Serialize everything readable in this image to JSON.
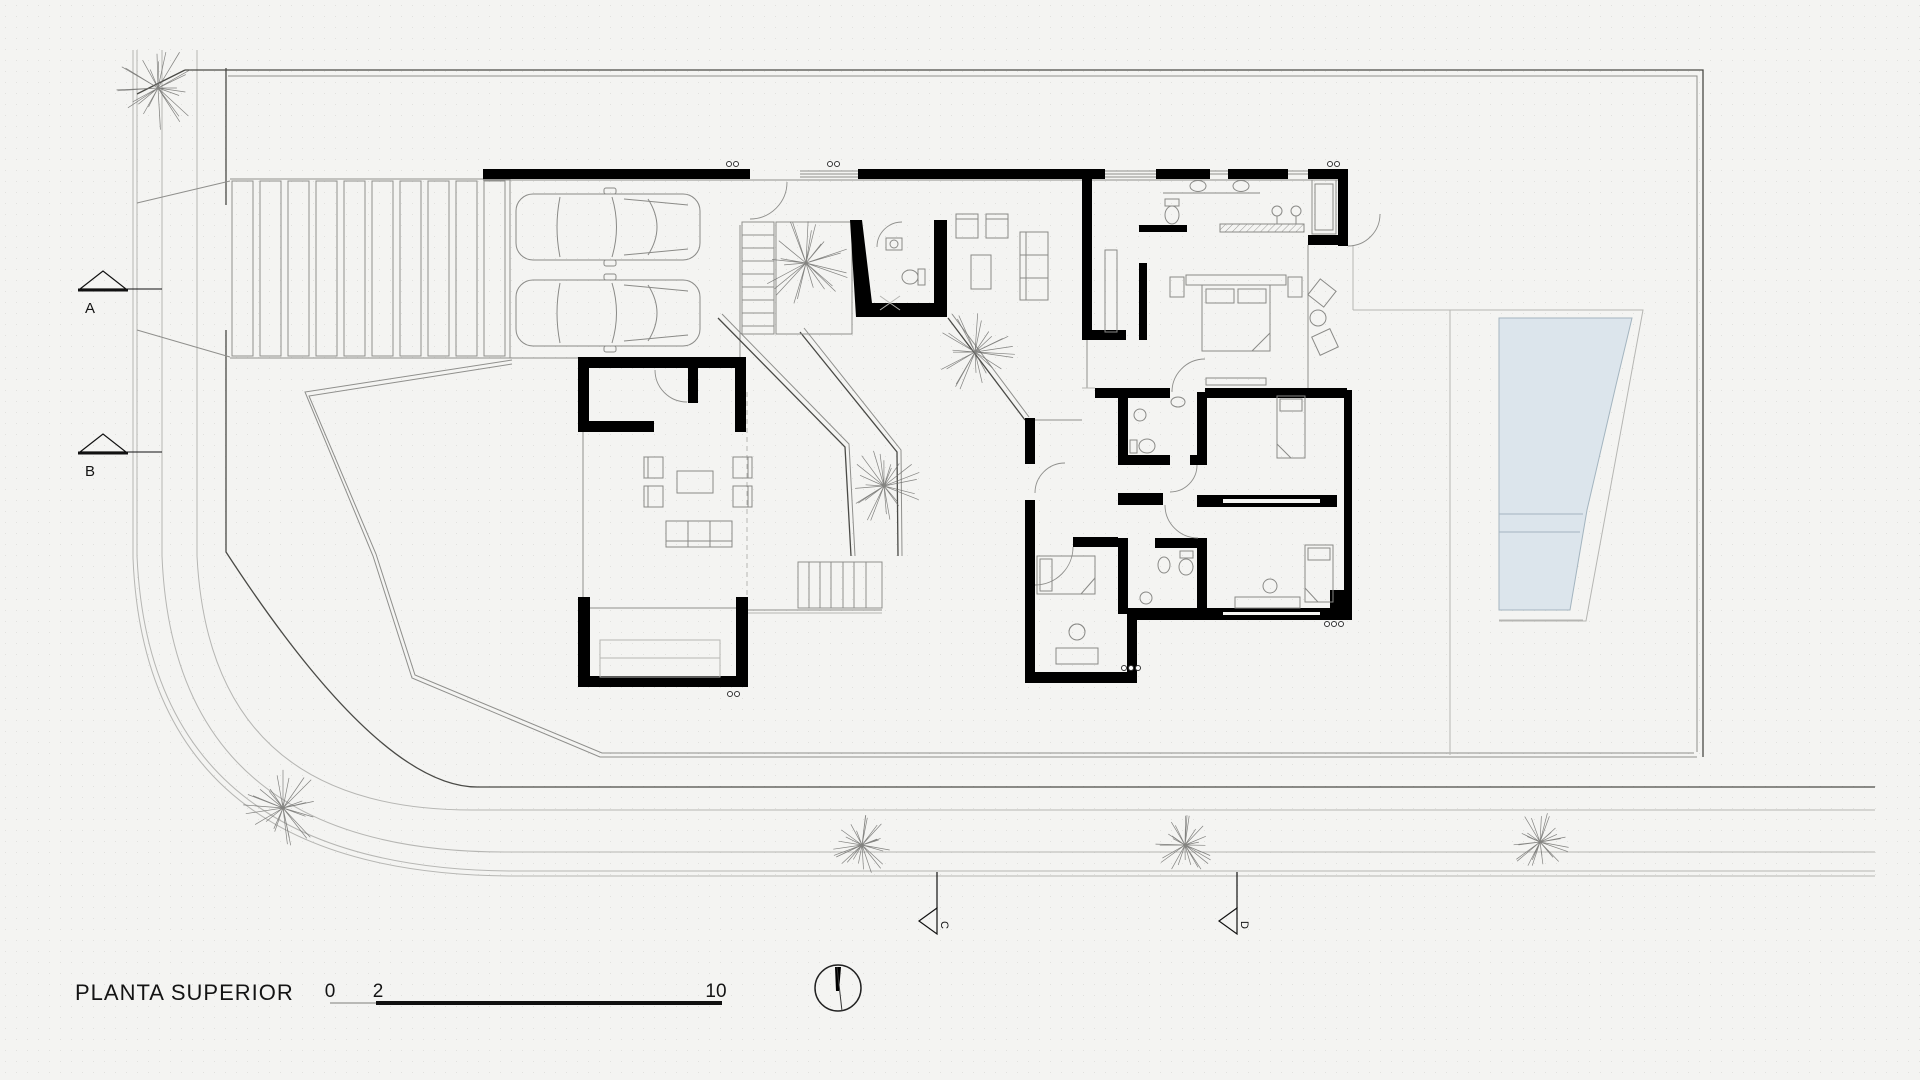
{
  "drawing": {
    "title": "PLANTA SUPERIOR"
  },
  "scale_bar": {
    "tick_start": "0",
    "tick_mid": "2",
    "tick_end": "10"
  },
  "section_markers": {
    "a": "A",
    "b": "B",
    "c": "C",
    "d": "D"
  },
  "colors": {
    "background": "#f4f4f2",
    "wall": "#000000",
    "line_dark": "#4a4a46",
    "line_mid": "#8f8f8c",
    "line_light": "#b6b6b3",
    "furniture": "#8a8a87",
    "pool_fill": "#dce5ec",
    "pool_line": "#a3b4bf",
    "tree": "#6f6f6c",
    "text": "#141414"
  }
}
